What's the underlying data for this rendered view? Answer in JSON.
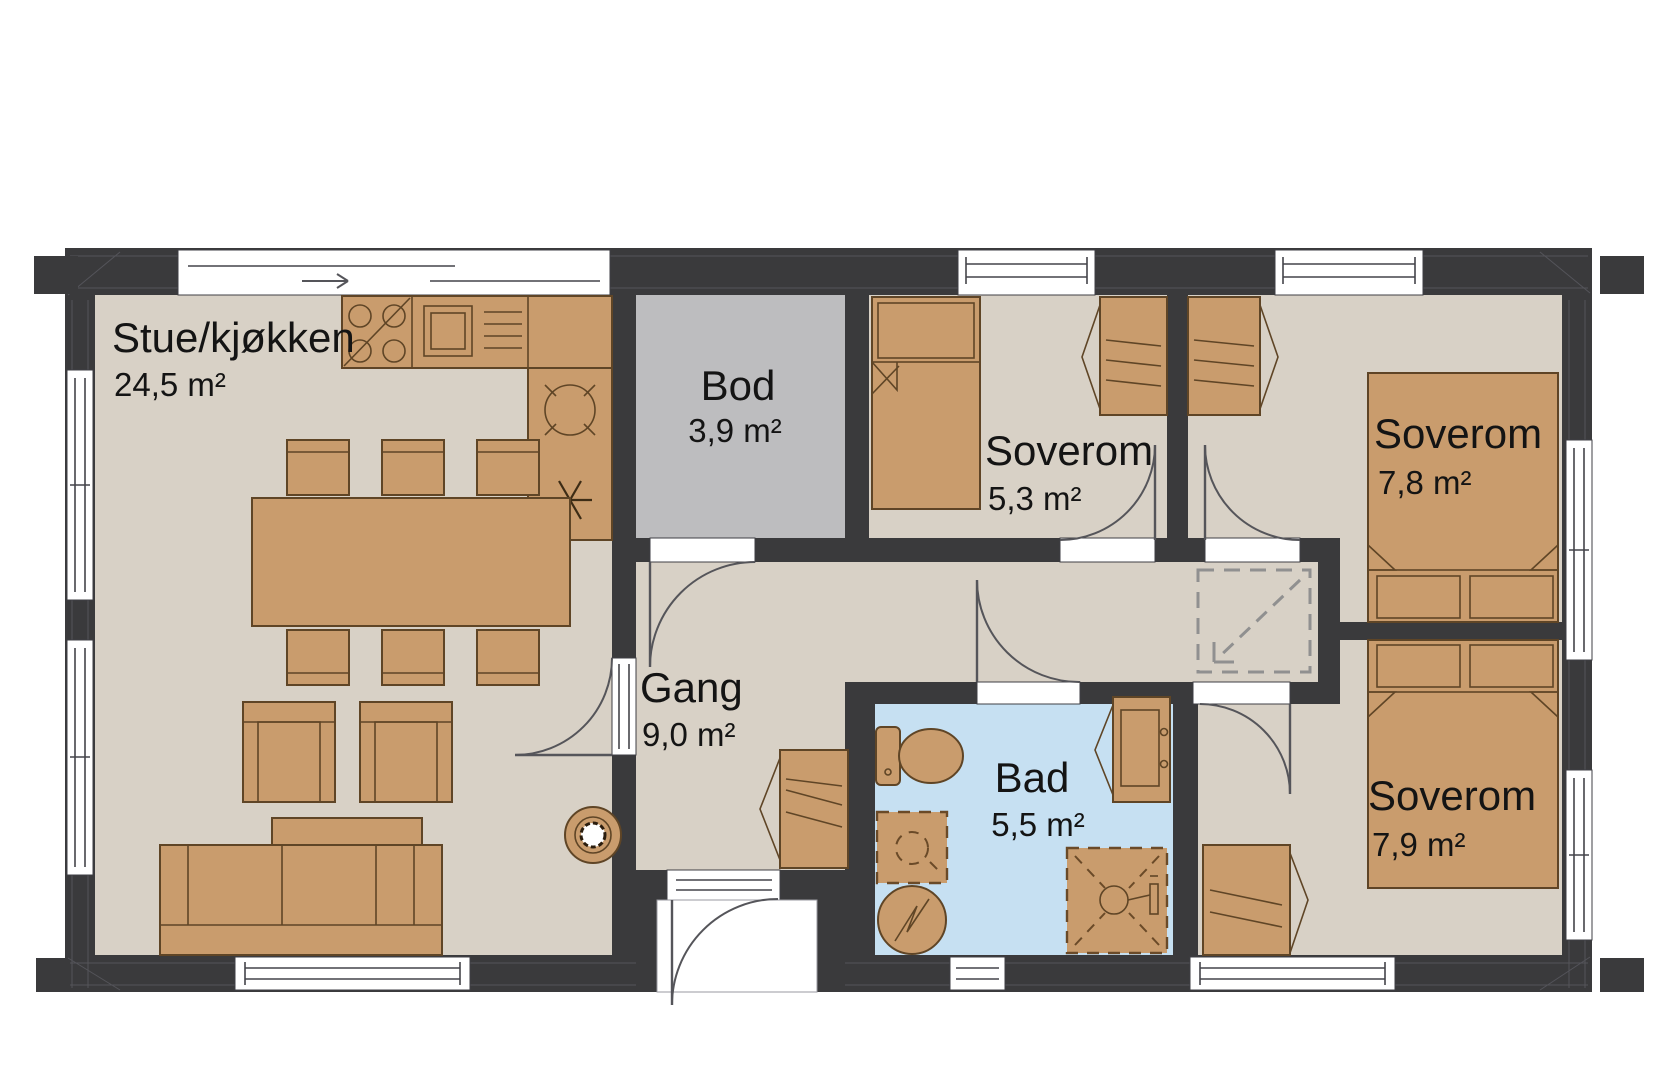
{
  "meta": {
    "document_type": "floor-plan",
    "language": "Norwegian",
    "total_rooms_labeled": 7
  },
  "palette": {
    "wall": "#3a3a3c",
    "floor": "#d8d1c6",
    "bod_floor": "#bdbdbf",
    "bath_floor": "#c6e0f2",
    "furniture": "#c99c6d",
    "furniture_stroke": "#5f4526",
    "dashed_symbol": "#909090",
    "door_arc": "#55555a",
    "text": "#141414",
    "background": "#ffffff"
  },
  "rooms": [
    {
      "key": "stue-kjokken",
      "name": "Stue/kjøkken",
      "area": "24,5 m²"
    },
    {
      "key": "bod",
      "name": "Bod",
      "area": "3,9 m²"
    },
    {
      "key": "soverom-1",
      "name": "Soverom",
      "area": "5,3 m²"
    },
    {
      "key": "soverom-2",
      "name": "Soverom",
      "area": "7,8 m²"
    },
    {
      "key": "gang",
      "name": "Gang",
      "area": "9,0 m²"
    },
    {
      "key": "bad",
      "name": "Bad",
      "area": "5,5 m²"
    },
    {
      "key": "soverom-3",
      "name": "Soverom",
      "area": "7,9 m²"
    }
  ],
  "icons": {
    "sliding-door-icon": "double offset lines with slide arrow",
    "window-icon": "white gap in wall with double frame line",
    "door-swing-icon": "quarter-circle arc with leaf line",
    "cooktop-icon": "square with 4 burner circles",
    "kitchen-sink-icon": "square basin with drainer lines",
    "round-basin-icon": "circle in corner worktop",
    "dishwasher-connection-icon": "six-spoke asterisk",
    "dining-table-icon": "rectangle with 6 chair squares",
    "armchair-icon": "square seat with arm bands",
    "coffee-table-icon": "plain rectangle",
    "sofa-icon": "3-seat rectangle with back band",
    "wood-stove-icon": "concentric circles",
    "single-bed-icon": "bed with pillow and folded duvet",
    "double-bed-icon": "bed with two pillows and folded duvet",
    "wardrobe-icon": "cabinet with shelf lines and open-door triangle",
    "toilet-icon": "tank and oval bowl",
    "washbasin-cabinet-icon": "cabinet with basin rectangle",
    "washing-machine-icon": "circle with zigzag",
    "appliance-connection-icon": "dashed square with circle",
    "shower-icon": "dashed square with cross and shower head",
    "attic-hatch-icon": "dashed square with diagonal arrow"
  }
}
